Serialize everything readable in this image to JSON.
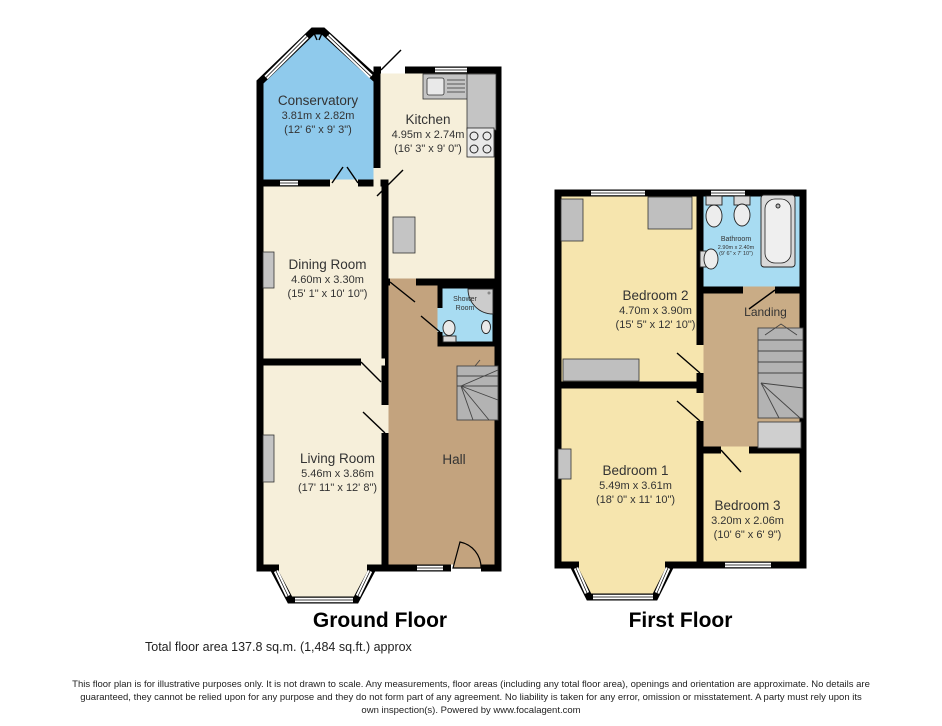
{
  "footer": {
    "total_area": "Total floor area 137.8 sq.m. (1,484 sq.ft.) approx",
    "disclaimer": "This floor plan is for illustrative purposes only. It is not drawn to scale. Any measurements, floor areas (including any total floor area), openings and orientation are approximate. No details are guaranteed, they cannot be relied upon for any purpose and they do not form part of any agreement. No liability is taken for any error, omission or misstatement. A party must rely upon its own inspection(s). Powered by www.focalagent.com"
  },
  "ground_floor": {
    "title": "Ground Floor",
    "rooms": {
      "conservatory": {
        "name": "Conservatory",
        "metric": "3.81m x 2.82m",
        "imperial": "(12' 6\" x 9' 3\")"
      },
      "kitchen": {
        "name": "Kitchen",
        "metric": "4.95m x 2.74m",
        "imperial": "(16' 3\" x 9' 0\")"
      },
      "dining": {
        "name": "Dining Room",
        "metric": "4.60m x 3.30m",
        "imperial": "(15' 1\" x 10' 10\")"
      },
      "living": {
        "name": "Living Room",
        "metric": "5.46m x 3.86m",
        "imperial": "(17' 11\" x 12' 8\")"
      },
      "hall": {
        "name": "Hall"
      },
      "shower": {
        "name_line1": "Shower",
        "name_line2": "Room"
      }
    }
  },
  "first_floor": {
    "title": "First Floor",
    "rooms": {
      "bedroom2": {
        "name": "Bedroom 2",
        "metric": "4.70m x 3.90m",
        "imperial": "(15' 5\" x 12' 10\")"
      },
      "bathroom": {
        "name": "Bathroom",
        "metric": "2.90m x 2.40m",
        "imperial": "(9' 6\" x 7' 10\")"
      },
      "landing": {
        "name": "Landing"
      },
      "bedroom1": {
        "name": "Bedroom 1",
        "metric": "5.49m x 3.61m",
        "imperial": "(18' 0\" x 11' 10\")"
      },
      "bedroom3": {
        "name": "Bedroom 3",
        "metric": "3.20m x 2.06m",
        "imperial": "(10' 6\" x 6' 9\")"
      }
    }
  },
  "colors": {
    "walls": "#000000",
    "cream": "#F6EFDA",
    "bedroom": "#F6E5AE",
    "conservatory": "#8FCAEC",
    "bath": "#A8DCF2",
    "hall": "#C3A37E",
    "landing": "#C9AC86",
    "stairs": "#B3B3B3",
    "fixture": "#C4C4C4"
  }
}
